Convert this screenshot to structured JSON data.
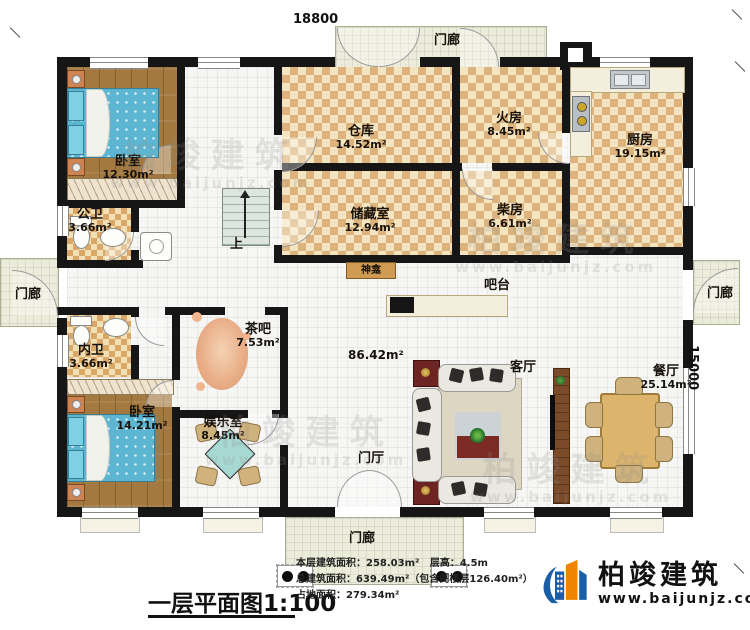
{
  "dimensions": {
    "width": "18800",
    "height": "15000"
  },
  "rooms": {
    "bedroom1": {
      "name": "卧室",
      "area": "12.30m²"
    },
    "pub_bath": {
      "name": "公卫",
      "area": "3.66m²"
    },
    "warehouse": {
      "name": "仓库",
      "area": "14.52m²"
    },
    "fire_room": {
      "name": "火房",
      "area": "8.45m²"
    },
    "kitchen": {
      "name": "厨房",
      "area": "19.15m²"
    },
    "storage": {
      "name": "储藏室",
      "area": "12.94m²"
    },
    "wood_room": {
      "name": "柴房",
      "area": "6.61m²"
    },
    "inner_bath": {
      "name": "内卫",
      "area": "3.66m²"
    },
    "bedroom2": {
      "name": "卧室",
      "area": "14.21m²"
    },
    "tea_bar": {
      "name": "茶吧",
      "area": "7.53m²"
    },
    "rec_room": {
      "name": "娱乐室",
      "area": "8.45m²"
    },
    "dining": {
      "name": "餐厅",
      "area": "25.14m²"
    }
  },
  "labels": {
    "porch": "门廊",
    "foyer": "门厅",
    "living": "客厅",
    "bar": "吧台",
    "shrine": "神龛",
    "stairs_up": "上",
    "great_area": "86.42m²"
  },
  "title_block": {
    "title": "一层平面图1:100",
    "floor_area": "本层建筑面积：258.03m²",
    "story_height": "层高：4.5m",
    "total_area": "总建筑面积：639.49m²（包含阁楼层126.40m²）",
    "footprint": "占地面积：279.34m²"
  },
  "brand": {
    "name": "柏竣建筑",
    "url": "www.baijunjz.com"
  },
  "watermark": {
    "name": "柏竣建筑",
    "url": "www.baijunjz.com"
  }
}
